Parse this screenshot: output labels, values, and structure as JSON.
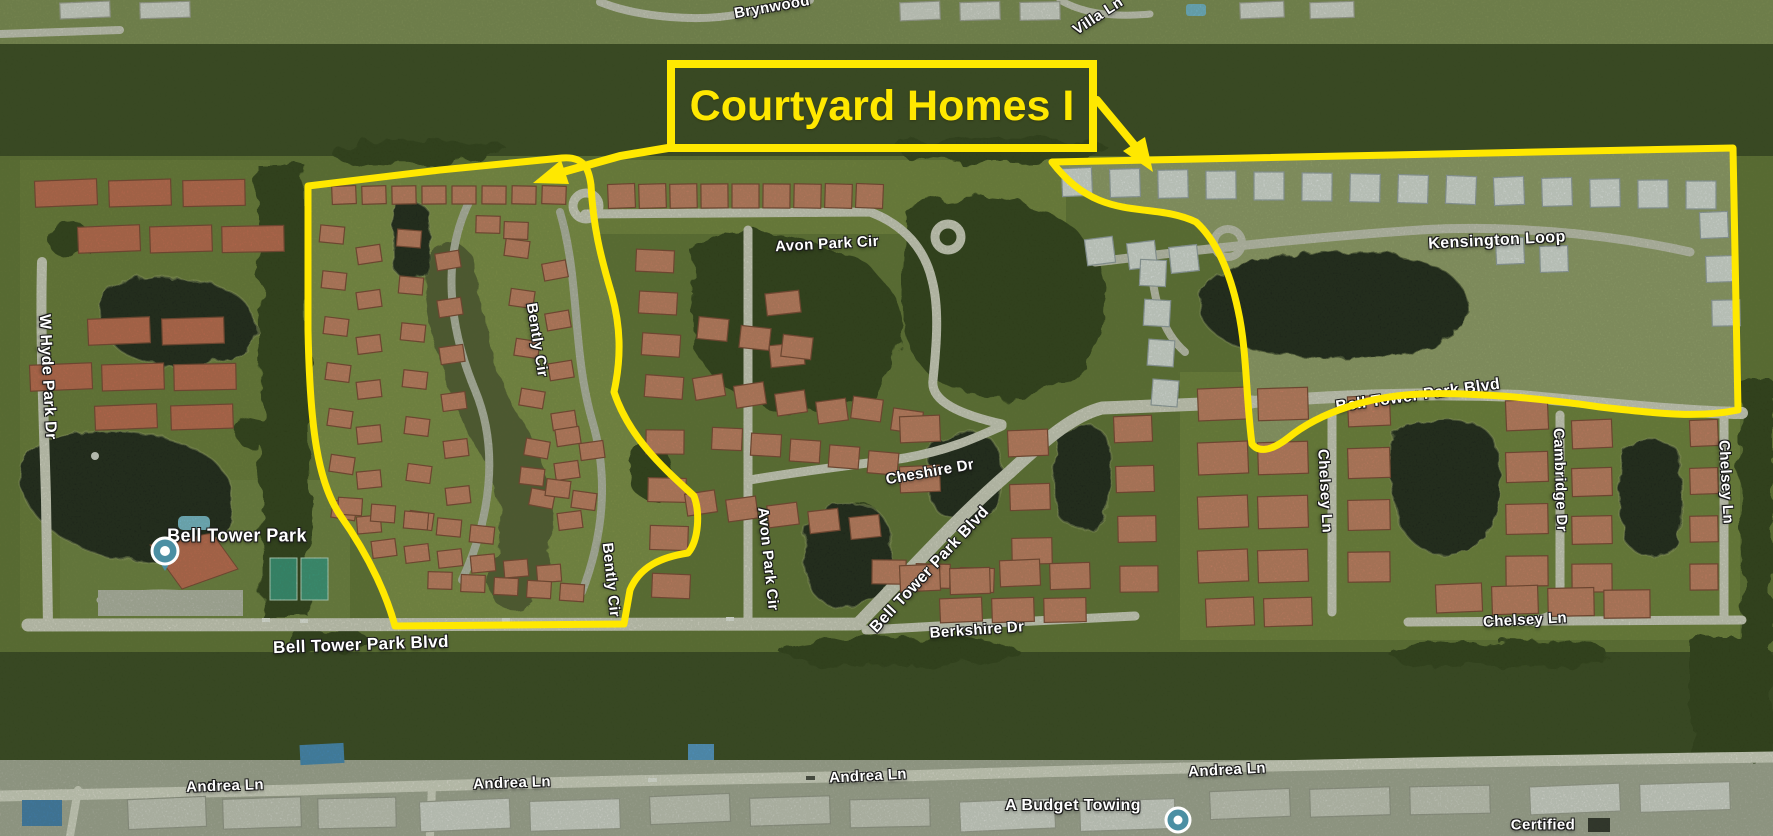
{
  "annotation": {
    "title": "Courtyard Homes I",
    "highlight_color": "#ffe800",
    "outlined_regions": [
      "left-courtyard-homes-area",
      "right-kensington-area"
    ]
  },
  "map": {
    "type": "satellite-aerial",
    "street_labels": [
      {
        "text": "Brynwood"
      },
      {
        "text": "Villa Ln"
      },
      {
        "text": "W Hyde Park Dr"
      },
      {
        "text": "Avon Park Cir"
      },
      {
        "text": "Kensington Loop"
      },
      {
        "text": "Bell Tower Park Blvd"
      },
      {
        "text": "Cheshire Dr"
      },
      {
        "text": "Avon Park Cir"
      },
      {
        "text": "Bell Tower Park Blvd"
      },
      {
        "text": "Berkshire Dr"
      },
      {
        "text": "Bell Tower Park Blvd"
      },
      {
        "text": "Bently Cir"
      },
      {
        "text": "Bently Cir"
      },
      {
        "text": "Chelsey Ln"
      },
      {
        "text": "Cambridge Dr"
      },
      {
        "text": "Chelsey Ln"
      },
      {
        "text": "Chelsey Ln"
      },
      {
        "text": "Andrea Ln"
      },
      {
        "text": "Andrea Ln"
      },
      {
        "text": "Andrea Ln"
      },
      {
        "text": "Andrea Ln"
      }
    ],
    "places": {
      "park": {
        "name": "Bell Tower Park",
        "marker_color": "#4b8fa3"
      },
      "towing": {
        "name": "A Budget Towing",
        "marker_color": "#4b8fa3"
      },
      "partial_right": {
        "name": "Certified"
      }
    }
  }
}
